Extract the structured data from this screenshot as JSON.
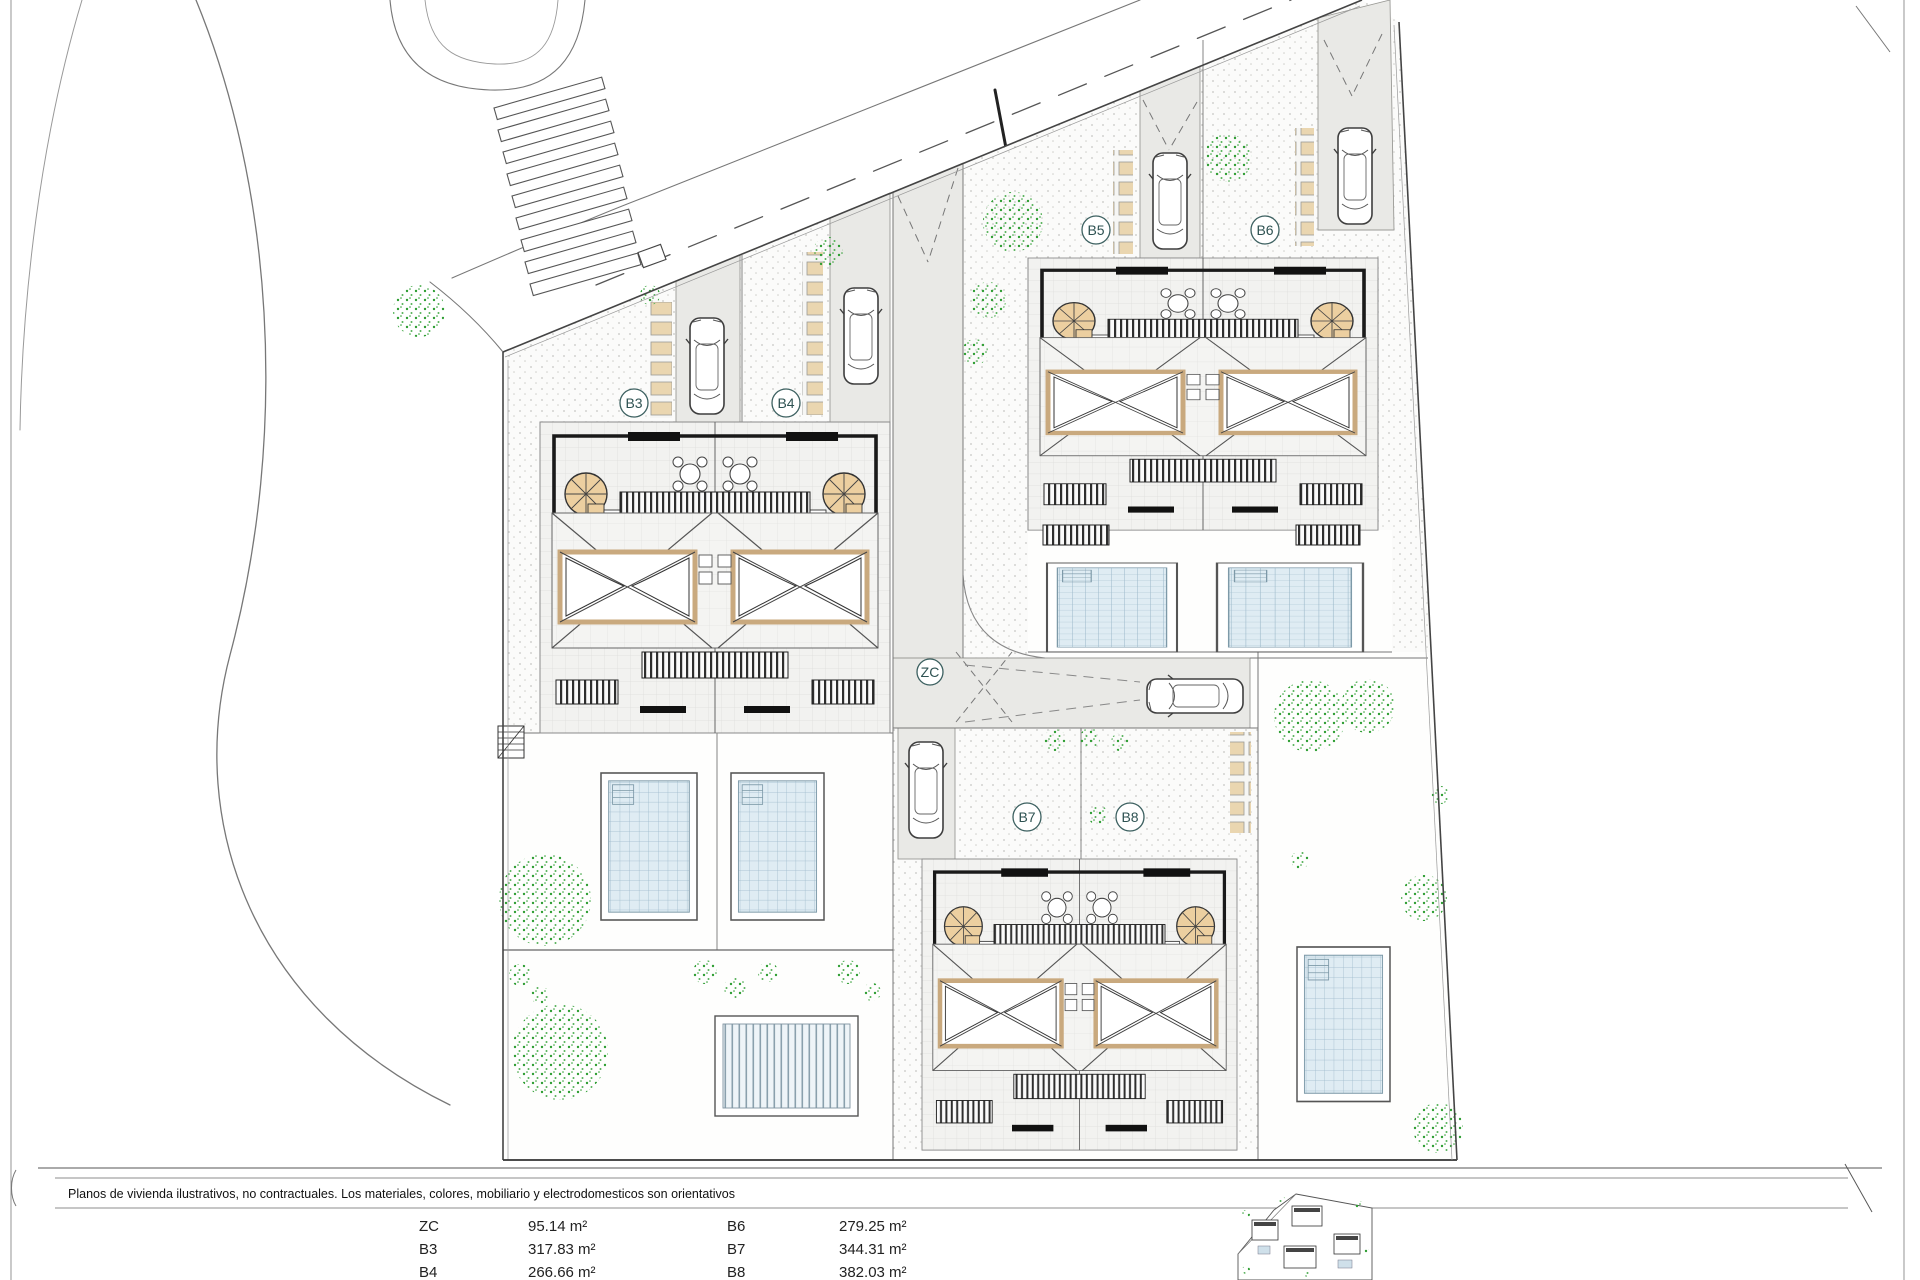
{
  "plan": {
    "units": {
      "b3": "B3",
      "b4": "B4",
      "b5": "B5",
      "b6": "B6",
      "b7": "B7",
      "b8": "B8",
      "zc": "ZC"
    },
    "footer": {
      "disclaimer": "Planos de vivienda ilustrativos, no contractuales. Los materiales, colores, mobiliario y electrodomesticos son orientativos"
    },
    "legend": {
      "col1": [
        {
          "id": "ZC",
          "area": "95.14 m²"
        },
        {
          "id": "B3",
          "area": "317.83 m²"
        },
        {
          "id": "B4",
          "area": "266.66 m²"
        }
      ],
      "col2": [
        {
          "id": "B6",
          "area": "279.25 m²"
        },
        {
          "id": "B7",
          "area": "344.31 m²"
        },
        {
          "id": "B8",
          "area": "382.03 m²"
        }
      ]
    },
    "colors": {
      "paver_tan": "#ead6b0",
      "stair_tan": "#eccfa0",
      "skylight_frame": "#c9a97e",
      "tree_green": "#2f9e33",
      "pool_blue": "#dfecf3",
      "drive_gray": "#e9e9e6"
    }
  }
}
